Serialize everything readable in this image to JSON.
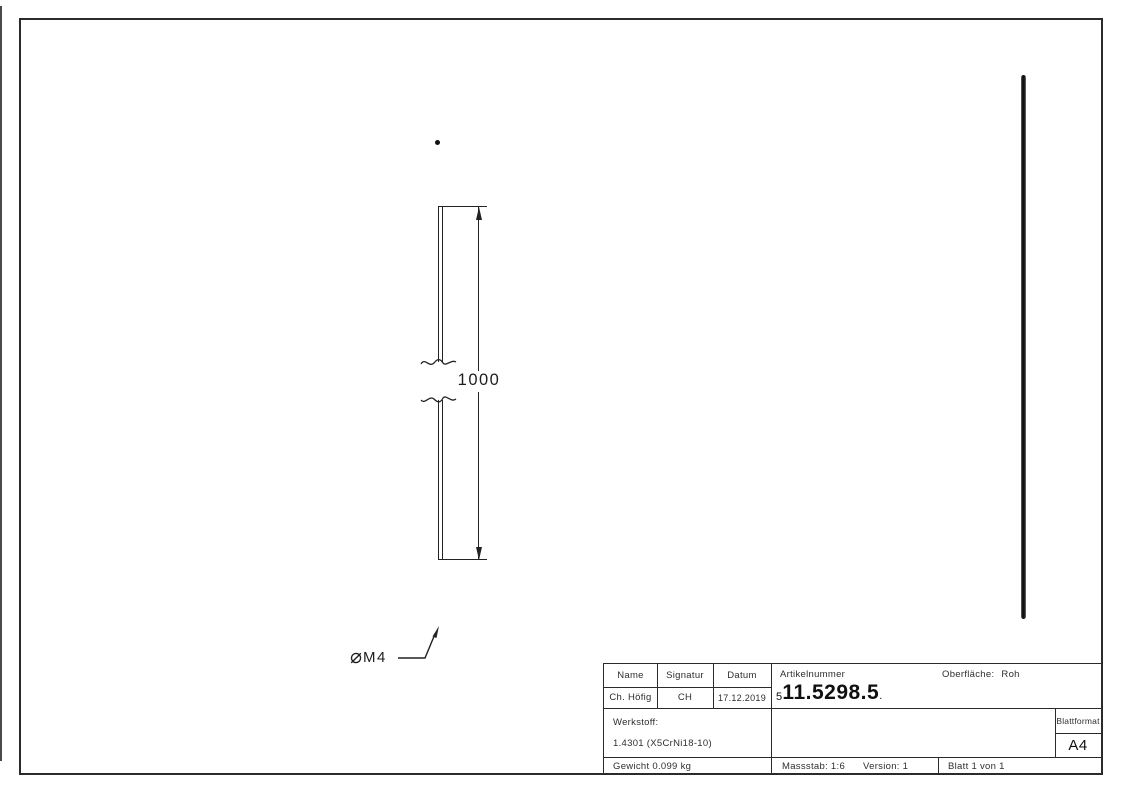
{
  "drawing": {
    "dimension_value": "1000",
    "thread_symbol": "⌀",
    "thread_text": "M4",
    "line_color": "#222222",
    "rod_color": "#111111"
  },
  "title_block": {
    "header": {
      "name": "Name",
      "signatur": "Signatur",
      "datum": "Datum"
    },
    "values": {
      "name": "Ch. Höfig",
      "signatur": "CH",
      "datum": "17.12.2019"
    },
    "artikelnummer": {
      "label": "Artikelnummer",
      "prefix": "5",
      "value": "11.5298.5",
      "suffix": "."
    },
    "oberflaeche": {
      "label": "Oberfläche:",
      "value": "Roh"
    },
    "werkstoff": {
      "label": "Werkstoff:",
      "value": "1.4301 (X5CrNi18-10)"
    },
    "blattformat": {
      "label": "Blattformat",
      "value": "A4"
    },
    "gewicht": "Gewicht 0.099 kg",
    "massstab": "Massstab: 1:6",
    "version": "Version: 1",
    "blatt": "Blatt 1 von 1"
  }
}
